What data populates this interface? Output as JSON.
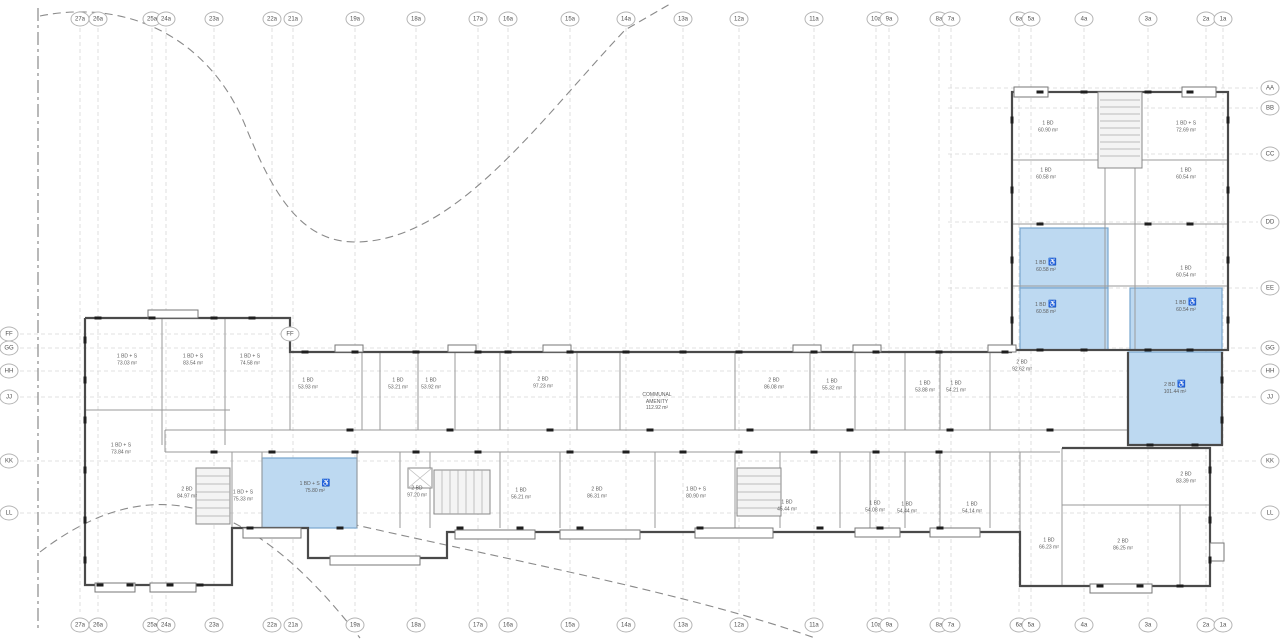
{
  "drawing": {
    "kind_label": "residential floor plan",
    "amenity": {
      "l1": "COMMUNAL",
      "l2": "AMENITY",
      "l3": "112.92 m²"
    },
    "accessible_icon": "♿"
  },
  "colors": {
    "highlight_fill": "#bdd9f1",
    "highlight_border": "#78a7cf",
    "wall": "#4a4a4a",
    "partition": "#9a9a9a",
    "grid_line": "#d7d7d7",
    "boundary_dash": "#8a8a8a",
    "bubble_border": "#b4b4b4",
    "label_text": "#5d5d5d",
    "tick": "#1e1e1e"
  },
  "grid": {
    "columns": [
      {
        "label": "27a",
        "x": 80
      },
      {
        "label": "26a",
        "x": 98
      },
      {
        "label": "25a",
        "x": 152
      },
      {
        "label": "24a",
        "x": 166
      },
      {
        "label": "23a",
        "x": 214
      },
      {
        "label": "22a",
        "x": 272
      },
      {
        "label": "21a",
        "x": 293
      },
      {
        "label": "19a",
        "x": 355
      },
      {
        "label": "18a",
        "x": 416
      },
      {
        "label": "17a",
        "x": 478
      },
      {
        "label": "16a",
        "x": 508
      },
      {
        "label": "15a",
        "x": 570
      },
      {
        "label": "14a",
        "x": 626
      },
      {
        "label": "13a",
        "x": 683
      },
      {
        "label": "12a",
        "x": 739
      },
      {
        "label": "11a",
        "x": 814
      },
      {
        "label": "10a",
        "x": 876
      },
      {
        "label": "9a",
        "x": 889
      },
      {
        "label": "8a",
        "x": 939
      },
      {
        "label": "7a",
        "x": 951
      },
      {
        "label": "6a",
        "x": 1019
      },
      {
        "label": "5a",
        "x": 1031
      },
      {
        "label": "4a",
        "x": 1084
      },
      {
        "label": "3a",
        "x": 1148
      },
      {
        "label": "2a",
        "x": 1206
      },
      {
        "label": "1a",
        "x": 1223
      }
    ],
    "rows": [
      {
        "label": "AA",
        "y": 88,
        "x1": 948,
        "x2": 1258,
        "left": false,
        "right": true
      },
      {
        "label": "BB",
        "y": 108,
        "x1": 948,
        "x2": 1258,
        "left": false,
        "right": true
      },
      {
        "label": "CC",
        "y": 154,
        "x1": 948,
        "x2": 1258,
        "left": false,
        "right": true
      },
      {
        "label": "DD",
        "y": 222,
        "x1": 948,
        "x2": 1258,
        "left": false,
        "right": true
      },
      {
        "label": "EE",
        "y": 288,
        "x1": 948,
        "x2": 1258,
        "left": false,
        "right": true
      },
      {
        "label": "FF",
        "y": 334,
        "x1": 20,
        "x2": 282,
        "left": true,
        "right": false
      },
      {
        "label": "GG",
        "y": 348,
        "x1": 20,
        "x2": 1258,
        "left": true,
        "right": true
      },
      {
        "label": "HH",
        "y": 371,
        "x1": 20,
        "x2": 1258,
        "left": true,
        "right": true
      },
      {
        "label": "JJ",
        "y": 397,
        "x1": 20,
        "x2": 1258,
        "left": true,
        "right": true
      },
      {
        "label": "KK",
        "y": 461,
        "x1": 20,
        "x2": 1258,
        "left": true,
        "right": true
      },
      {
        "label": "LL",
        "y": 513,
        "x1": 20,
        "x2": 1258,
        "left": true,
        "right": true
      }
    ],
    "extra_bubbles": [
      {
        "label": "FF",
        "x": 290,
        "y": 334
      }
    ],
    "bubble_rows": {
      "top_y": 19,
      "bottom_y": 625,
      "left_x": 9,
      "right_x": 1270
    }
  },
  "highlighted_rooms": [
    {
      "x": 1020,
      "y": 228,
      "w": 88,
      "h": 60
    },
    {
      "x": 1020,
      "y": 288,
      "w": 88,
      "h": 62
    },
    {
      "x": 1130,
      "y": 288,
      "w": 92,
      "h": 62
    },
    {
      "x": 1128,
      "y": 352,
      "w": 94,
      "h": 93
    },
    {
      "x": 262,
      "y": 458,
      "w": 95,
      "h": 70
    }
  ],
  "rooms": [
    {
      "name": "1 BD",
      "area": "60.90 m²",
      "x": 1048,
      "y": 127,
      "accessible": false
    },
    {
      "name": "1 BD + S",
      "area": "72.69 m²",
      "x": 1186,
      "y": 127,
      "accessible": false
    },
    {
      "name": "1 BD",
      "area": "60.58 m²",
      "x": 1046,
      "y": 174,
      "accessible": false
    },
    {
      "name": "1 BD",
      "area": "60.54 m²",
      "x": 1186,
      "y": 174,
      "accessible": false
    },
    {
      "name": "1 BD",
      "area": "60.58 m²",
      "x": 1046,
      "y": 266,
      "accessible": true
    },
    {
      "name": "1 BD",
      "area": "60.54 m²",
      "x": 1186,
      "y": 272,
      "accessible": false
    },
    {
      "name": "1 BD",
      "area": "60.58 m²",
      "x": 1046,
      "y": 308,
      "accessible": true
    },
    {
      "name": "1 BD",
      "area": "60.54 m²",
      "x": 1186,
      "y": 306,
      "accessible": true
    },
    {
      "name": "1 BD + S",
      "area": "73.03 m²",
      "x": 127,
      "y": 360,
      "accessible": false
    },
    {
      "name": "1 BD + S",
      "area": "83.54 m²",
      "x": 193,
      "y": 360,
      "accessible": false
    },
    {
      "name": "1 BD + S",
      "area": "74.58 m²",
      "x": 250,
      "y": 360,
      "accessible": false
    },
    {
      "name": "1 BD",
      "area": "53.93 m²",
      "x": 308,
      "y": 384,
      "accessible": false
    },
    {
      "name": "1 BD",
      "area": "53.21 m²",
      "x": 398,
      "y": 384,
      "accessible": false
    },
    {
      "name": "1 BD",
      "area": "53.92 m²",
      "x": 431,
      "y": 384,
      "accessible": false
    },
    {
      "name": "2 BD",
      "area": "97.23 m²",
      "x": 543,
      "y": 383,
      "accessible": false
    },
    {
      "name": "2 BD",
      "area": "86.08 m²",
      "x": 774,
      "y": 384,
      "accessible": false
    },
    {
      "name": "1 BD",
      "area": "55.32 m²",
      "x": 832,
      "y": 385,
      "accessible": false
    },
    {
      "name": "1 BD",
      "area": "53.88 m²",
      "x": 925,
      "y": 387,
      "accessible": false
    },
    {
      "name": "1 BD",
      "area": "54.21 m²",
      "x": 956,
      "y": 387,
      "accessible": false
    },
    {
      "name": "2 BD",
      "area": "92.62 m²",
      "x": 1022,
      "y": 366,
      "accessible": false
    },
    {
      "name": "2 BD",
      "area": "101.44 m²",
      "x": 1175,
      "y": 388,
      "accessible": true
    },
    {
      "name": "1 BD + S",
      "area": "73.84 m²",
      "x": 121,
      "y": 449,
      "accessible": false
    },
    {
      "name": "2 BD",
      "area": "84.97 m²",
      "x": 187,
      "y": 493,
      "accessible": false
    },
    {
      "name": "1 BD + S",
      "area": "75.33 m²",
      "x": 243,
      "y": 496,
      "accessible": false
    },
    {
      "name": "1 BD + S",
      "area": "75.80 m²",
      "x": 315,
      "y": 487,
      "accessible": true
    },
    {
      "name": "2 BD",
      "area": "97.20 m²",
      "x": 417,
      "y": 492,
      "accessible": false
    },
    {
      "name": "1 BD",
      "area": "56.21 m²",
      "x": 521,
      "y": 494,
      "accessible": false
    },
    {
      "name": "2 BD",
      "area": "86.31 m²",
      "x": 597,
      "y": 493,
      "accessible": false
    },
    {
      "name": "1 BD + S",
      "area": "80.90 m²",
      "x": 696,
      "y": 493,
      "accessible": false
    },
    {
      "name": "1 BD",
      "area": "45.44 m²",
      "x": 787,
      "y": 506,
      "accessible": false
    },
    {
      "name": "1 BD",
      "area": "54.08 m²",
      "x": 875,
      "y": 507,
      "accessible": false
    },
    {
      "name": "1 BD",
      "area": "54.44 m²",
      "x": 907,
      "y": 508,
      "accessible": false
    },
    {
      "name": "1 BD",
      "area": "54.14 m²",
      "x": 972,
      "y": 508,
      "accessible": false
    },
    {
      "name": "1 BD",
      "area": "66.23 m²",
      "x": 1049,
      "y": 544,
      "accessible": false
    },
    {
      "name": "2 BD",
      "area": "83.39 m²",
      "x": 1186,
      "y": 478,
      "accessible": false
    },
    {
      "name": "2 BD",
      "area": "86.25 m²",
      "x": 1123,
      "y": 545,
      "accessible": false
    }
  ]
}
